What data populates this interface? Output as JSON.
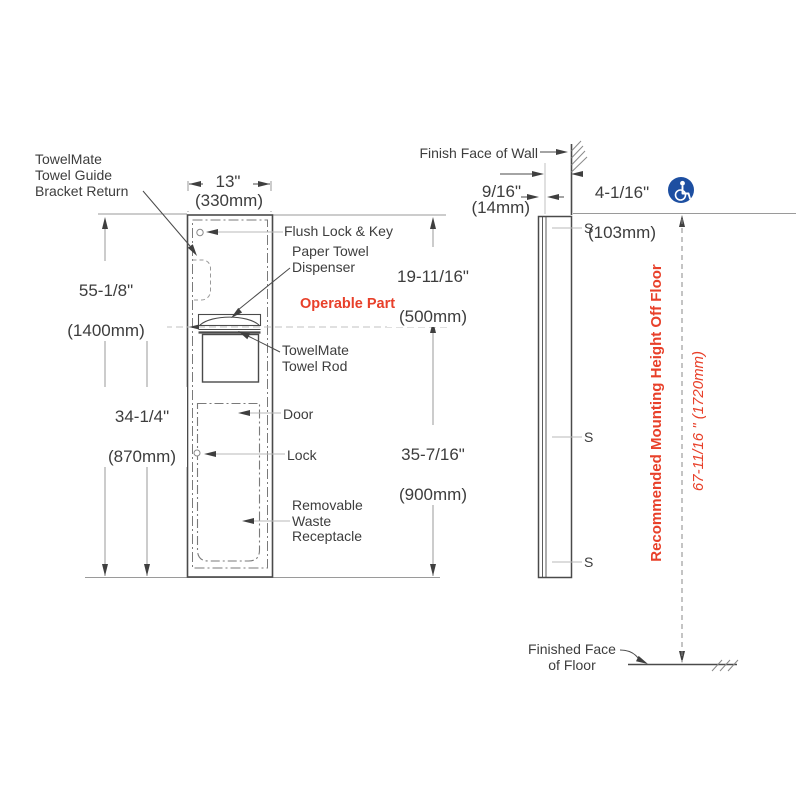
{
  "colors": {
    "accent_red": "#E8402A",
    "accessibility_blue": "#1D4FA1",
    "line_dark": "#4A4A4A",
    "line_leader": "#B8B8B8"
  },
  "front_view": {
    "width_in": "13\"",
    "width_mm": "(330mm)",
    "overall_height_in": "55-1/8\"",
    "overall_height_mm": "(1400mm)",
    "operable_height_in": "34-1/4\"",
    "operable_height_mm": "(870mm)",
    "top_to_operable_in": "19-11/16\"",
    "top_to_operable_mm": "(500mm)",
    "operable_to_floor_in": "35-7/16\"",
    "operable_to_floor_mm": "(900mm)",
    "labels": {
      "bracket": "TowelMate\nTowel Guide\nBracket Return",
      "flush_lock": "Flush Lock & Key",
      "dispenser": "Paper Towel\nDispenser",
      "operable_part": "Operable Part",
      "towel_rod": "TowelMate\nTowel Rod",
      "door": "Door",
      "lock": "Lock",
      "waste": "Removable\nWaste\nReceptacle"
    }
  },
  "side_view": {
    "finish_wall": "Finish Face of Wall",
    "projection_in": "9/16\"",
    "projection_mm": "(14mm)",
    "recess_in": "4-1/16\"",
    "recess_mm": "(103mm)",
    "stud": "S",
    "mounting_height_label": "Recommended Mounting Height Off Floor",
    "mounting_height_value": "67-11/16 \" (1720mm)",
    "finish_floor": "Finished Face\nof Floor",
    "accessibility_icon": "wheelchair-accessibility-icon"
  }
}
